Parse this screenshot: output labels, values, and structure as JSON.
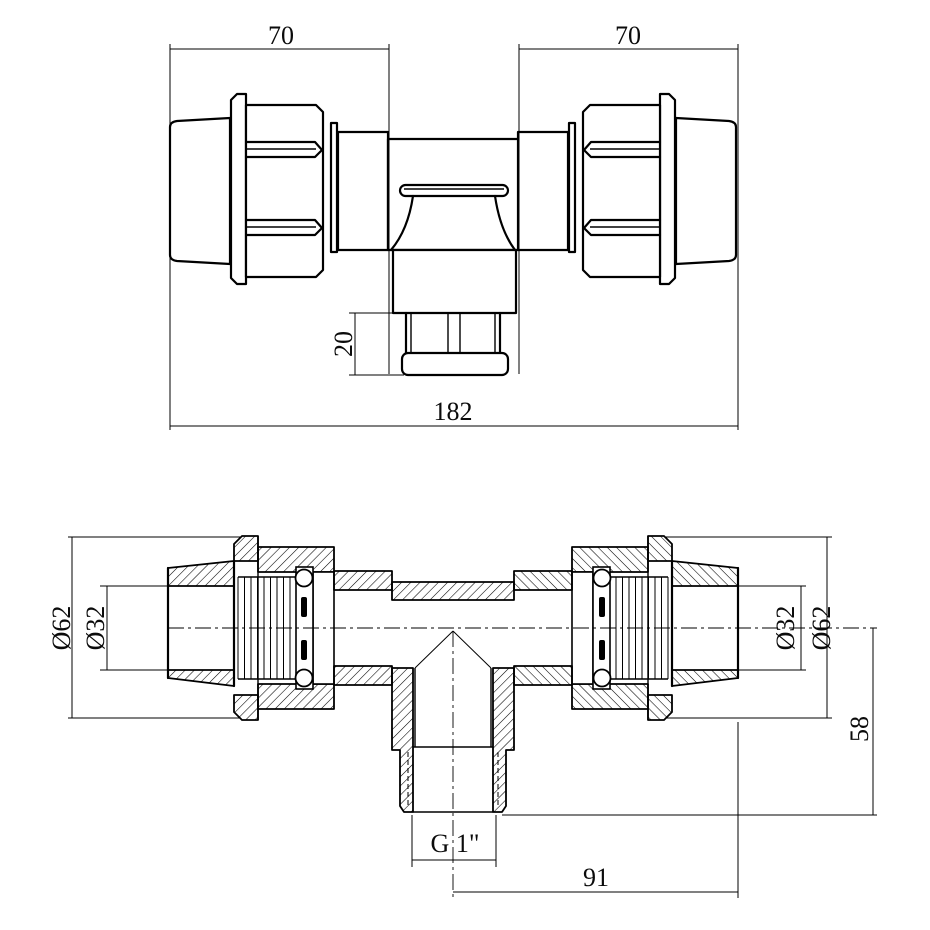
{
  "colors": {
    "line": "#000000",
    "background": "#ffffff"
  },
  "top_view": {
    "dim_left_takeoff": "70",
    "dim_right_takeoff": "70",
    "dim_branch_thread_length": "20",
    "dim_overall_length": "182"
  },
  "section_view": {
    "dim_left_outer_diameter": "Ø62",
    "dim_left_bore": "Ø32",
    "dim_right_bore": "Ø32",
    "dim_right_outer_diameter": "Ø62",
    "dim_axis_to_branch_end": "58",
    "dim_branch_thread": "G 1\"",
    "dim_axis_to_right_end": "91"
  }
}
